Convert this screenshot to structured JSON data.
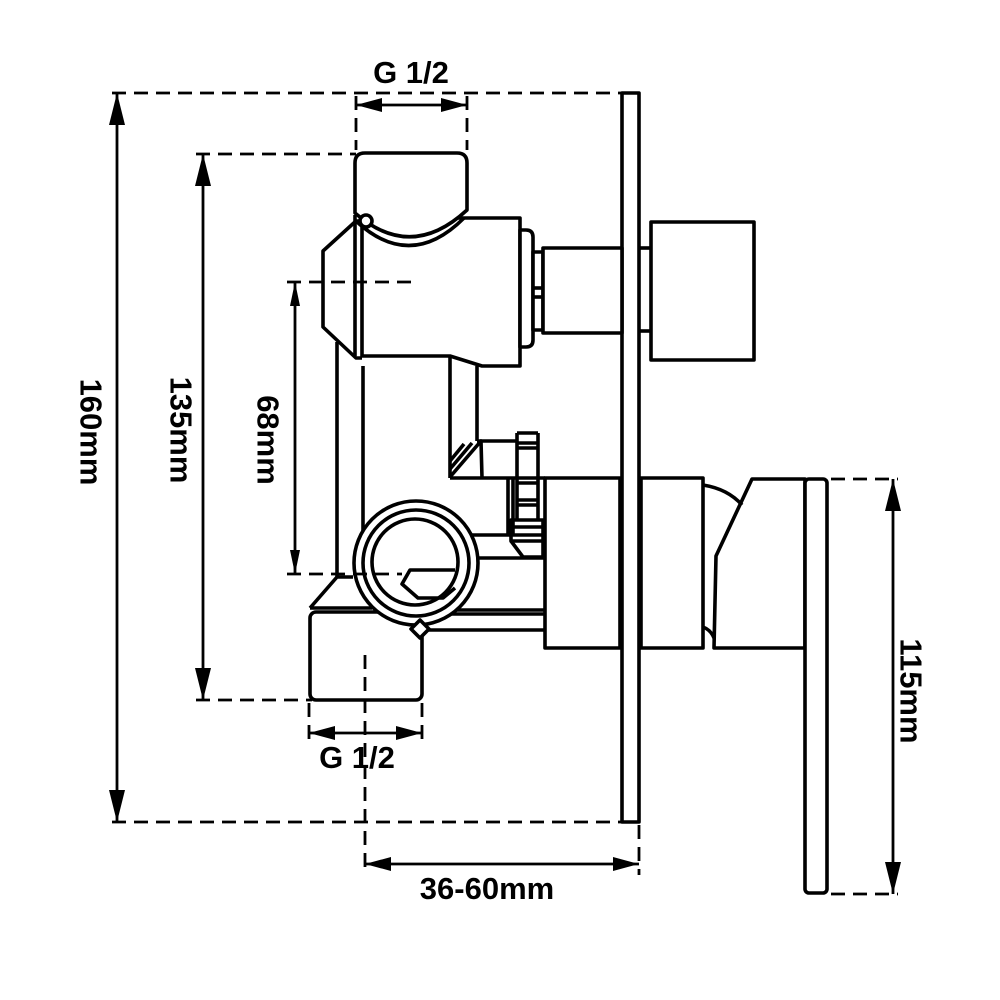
{
  "page": {
    "background": "#ffffff",
    "line_color": "#000000"
  },
  "diagram": {
    "kind": "technical-dimension-drawing",
    "subject": "concealed-shower-mixer-valve-side-view",
    "labels": {
      "thread_top": "G 1/2",
      "height_overall": "160mm",
      "height_body": "135mm",
      "port_offset": "68mm",
      "thread_bottom": "G 1/2",
      "wall_depth": "36-60mm",
      "handle_drop": "115mm"
    }
  }
}
